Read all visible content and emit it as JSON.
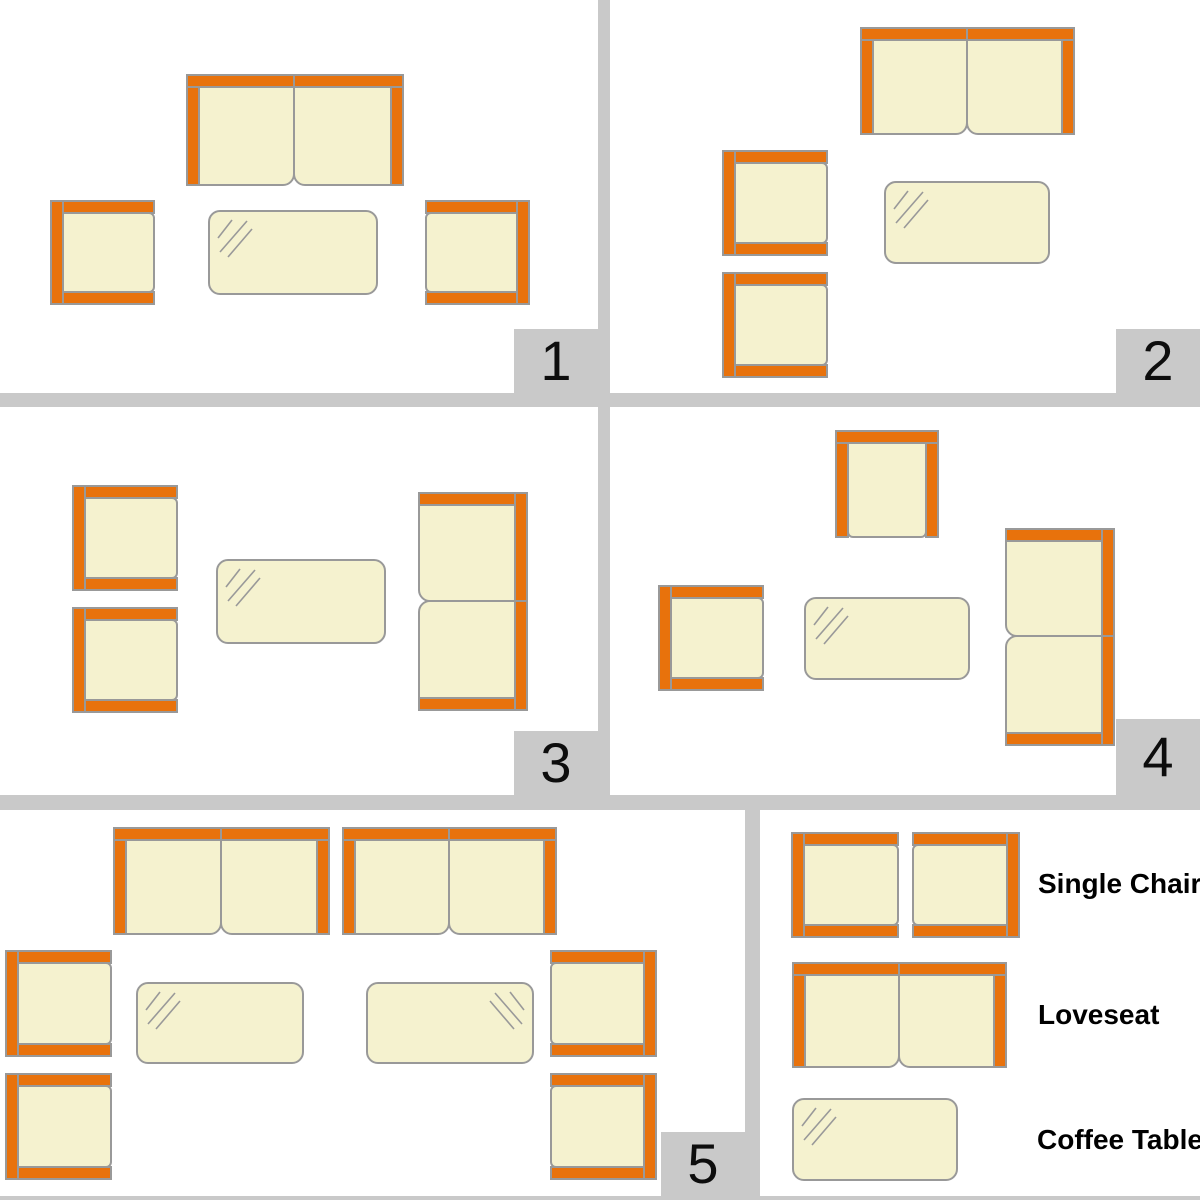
{
  "colors": {
    "orange": "#E8720C",
    "cream": "#F5F2CF",
    "outline": "#999999",
    "divider": "#C9C9C9",
    "text": "#000000"
  },
  "panels": [
    {
      "number": "1",
      "items": [
        {
          "type": "loveseat",
          "facing": "down",
          "x": 186,
          "y": 74,
          "w": 218,
          "h": 112
        },
        {
          "type": "chair",
          "facing": "right",
          "x": 50,
          "y": 200,
          "w": 105,
          "h": 105
        },
        {
          "type": "chair",
          "facing": "left",
          "x": 425,
          "y": 200,
          "w": 105,
          "h": 105
        },
        {
          "type": "table",
          "hatch": "tl",
          "x": 208,
          "y": 210,
          "w": 170,
          "h": 85
        }
      ]
    },
    {
      "number": "2",
      "items": [
        {
          "type": "loveseat",
          "facing": "down",
          "x": 250,
          "y": 27,
          "w": 215,
          "h": 108
        },
        {
          "type": "chair",
          "facing": "right",
          "x": 112,
          "y": 150,
          "w": 106,
          "h": 106
        },
        {
          "type": "chair",
          "facing": "right",
          "x": 112,
          "y": 272,
          "w": 106,
          "h": 106
        },
        {
          "type": "table",
          "hatch": "tl",
          "x": 274,
          "y": 181,
          "w": 166,
          "h": 83
        }
      ]
    },
    {
      "number": "3",
      "items": [
        {
          "type": "chair",
          "facing": "right",
          "x": 72,
          "y": 78,
          "w": 106,
          "h": 106
        },
        {
          "type": "chair",
          "facing": "right",
          "x": 72,
          "y": 200,
          "w": 106,
          "h": 106
        },
        {
          "type": "loveseat",
          "facing": "left",
          "x": 418,
          "y": 85,
          "w": 110,
          "h": 219
        },
        {
          "type": "table",
          "hatch": "tl",
          "x": 216,
          "y": 152,
          "w": 170,
          "h": 85
        }
      ]
    },
    {
      "number": "4",
      "items": [
        {
          "type": "chair",
          "facing": "down",
          "x": 225,
          "y": 23,
          "w": 104,
          "h": 108
        },
        {
          "type": "chair",
          "facing": "right",
          "x": 48,
          "y": 178,
          "w": 106,
          "h": 106
        },
        {
          "type": "loveseat",
          "facing": "left",
          "x": 395,
          "y": 121,
          "w": 110,
          "h": 218
        },
        {
          "type": "table",
          "hatch": "tl",
          "x": 194,
          "y": 190,
          "w": 166,
          "h": 83
        }
      ]
    },
    {
      "number": "5",
      "items": [
        {
          "type": "loveseat",
          "facing": "down",
          "x": 113,
          "y": 17,
          "w": 217,
          "h": 108
        },
        {
          "type": "loveseat",
          "facing": "down",
          "x": 342,
          "y": 17,
          "w": 215,
          "h": 108
        },
        {
          "type": "chair",
          "facing": "right",
          "x": 5,
          "y": 140,
          "w": 107,
          "h": 107
        },
        {
          "type": "chair",
          "facing": "right",
          "x": 5,
          "y": 263,
          "w": 107,
          "h": 107
        },
        {
          "type": "chair",
          "facing": "left",
          "x": 550,
          "y": 140,
          "w": 107,
          "h": 107
        },
        {
          "type": "chair",
          "facing": "left",
          "x": 550,
          "y": 263,
          "w": 107,
          "h": 107
        },
        {
          "type": "table",
          "hatch": "tl",
          "x": 136,
          "y": 172,
          "w": 168,
          "h": 82
        },
        {
          "type": "table",
          "hatch": "tr",
          "x": 366,
          "y": 172,
          "w": 168,
          "h": 82
        }
      ]
    }
  ],
  "legend": {
    "items": [
      {
        "label": "Single Chair",
        "shapes": [
          {
            "type": "chair",
            "facing": "right",
            "x": 31,
            "y": 22,
            "w": 108,
            "h": 106
          },
          {
            "type": "chair",
            "facing": "left",
            "x": 152,
            "y": 22,
            "w": 108,
            "h": 106
          }
        ]
      },
      {
        "label": "Loveseat",
        "shapes": [
          {
            "type": "loveseat",
            "facing": "down",
            "x": 32,
            "y": 152,
            "w": 215,
            "h": 106
          }
        ]
      },
      {
        "label": "Coffee Table",
        "shapes": [
          {
            "type": "table",
            "hatch": "tl",
            "x": 32,
            "y": 288,
            "w": 166,
            "h": 83
          }
        ]
      }
    ]
  }
}
